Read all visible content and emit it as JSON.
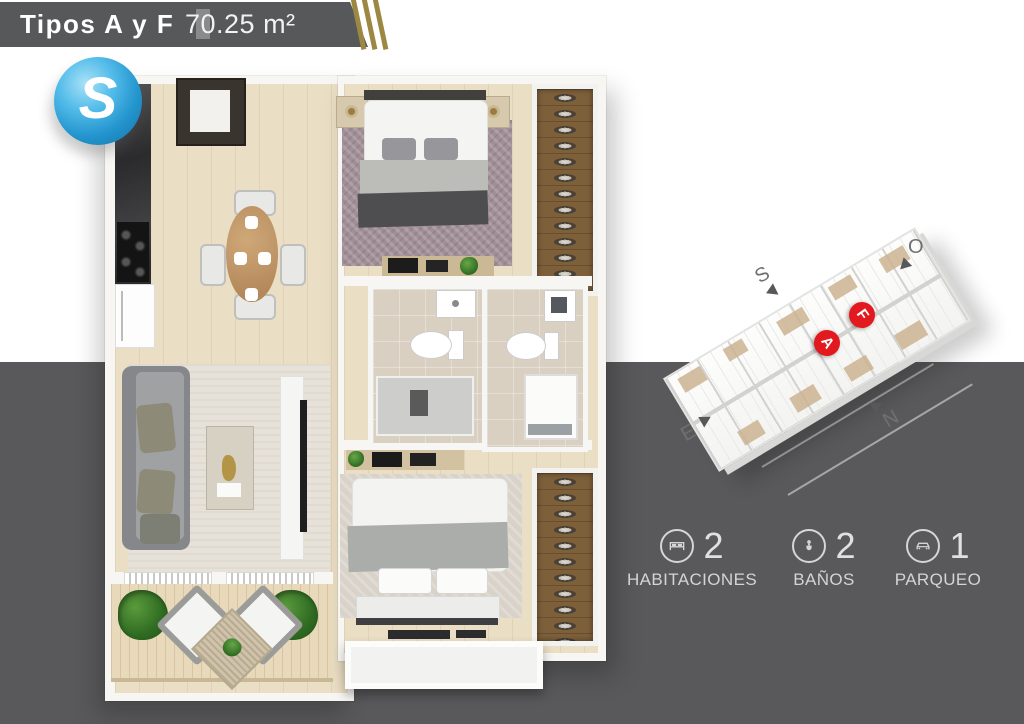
{
  "header": {
    "title": "Tipos A y F",
    "area": "70.25 m²"
  },
  "logo": {
    "letter": "S"
  },
  "overview": {
    "unit_markers": [
      {
        "label": "A"
      },
      {
        "label": "F"
      }
    ],
    "compass": {
      "south": "S",
      "west": "O",
      "east": "E",
      "north": "N"
    }
  },
  "stats": [
    {
      "icon": "bed-icon",
      "count": "2",
      "label": "HABITACIONES"
    },
    {
      "icon": "toilet-icon",
      "count": "2",
      "label": "BAÑOS"
    },
    {
      "icon": "car-icon",
      "count": "1",
      "label": "PARQUEO"
    }
  ],
  "colors": {
    "banner_gray": "#57585a",
    "background_bottom_gray": "#59595b",
    "stripe_gold": "#9c8743",
    "logo_blue": "#2aa7df",
    "marker_red": "#e2191e",
    "text_light": "#d6d6d6"
  }
}
